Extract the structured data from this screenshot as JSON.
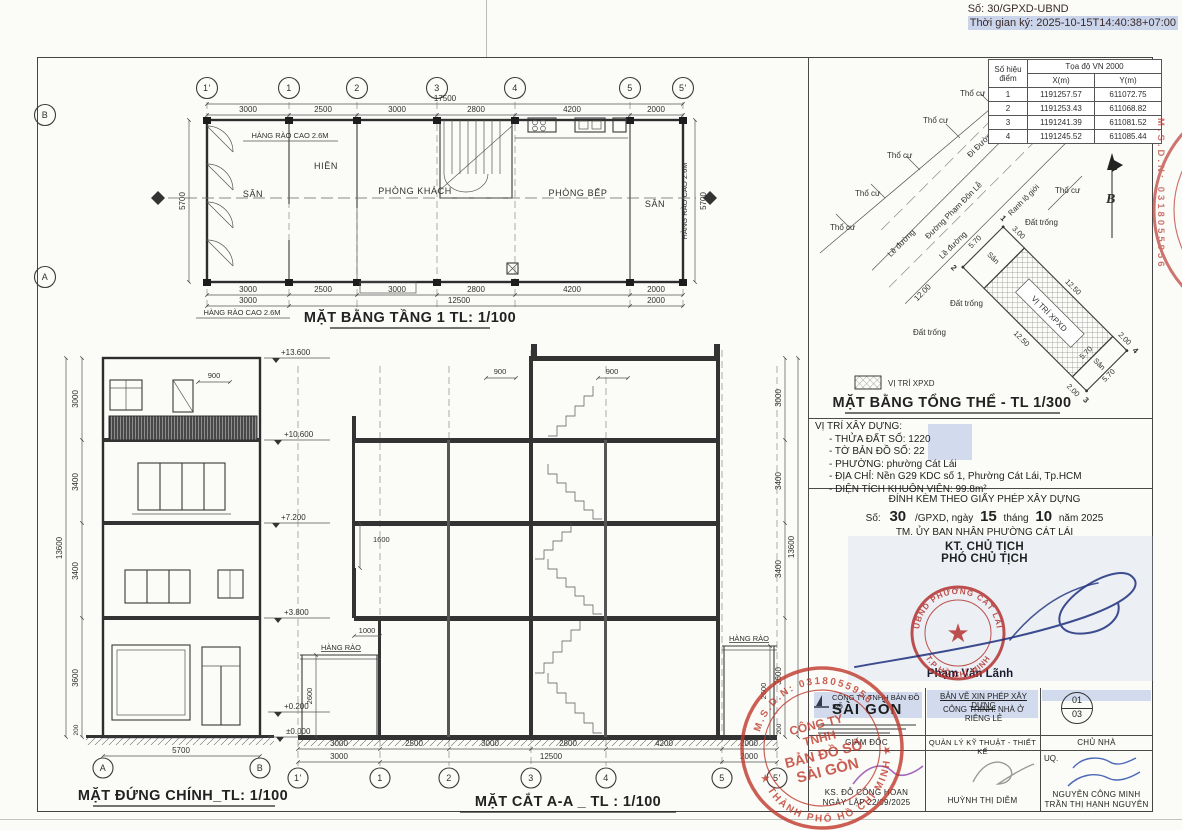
{
  "header": {
    "so": "Số: 30/GPXD-UBND",
    "time": "Thời gian ký: 2025-10-15T14:40:38+07:00"
  },
  "plan": {
    "title": "MẶT BẰNG TẦNG 1 TL: 1/100",
    "grids": [
      "1'",
      "1",
      "2",
      "3",
      "4",
      "5",
      "5'"
    ],
    "row_b": "B",
    "row_a": "A",
    "total": "17500",
    "segs": [
      "3000",
      "2500",
      "3000",
      "2800",
      "4200",
      "2000"
    ],
    "row2": [
      "3000",
      "12500",
      "2000"
    ],
    "side": "5700",
    "fence": "HÀNG RÀO CAO 2.6M",
    "rooms": [
      "SÂN",
      "HIÊN",
      "PHÒNG KHÁCH",
      "PHÒNG BẾP",
      "SÂN"
    ]
  },
  "elev": {
    "title": "MẶT ĐỨNG CHÍNH_TL: 1/100",
    "marks": [
      "+13.600",
      "+10.600",
      "+7.200",
      "+3.800",
      "+0.200",
      "±0.000"
    ],
    "vdims": [
      "3000",
      "3400",
      "3400",
      "3600",
      "200"
    ],
    "vtotal": "13600",
    "d900": "900",
    "d5700": "5700",
    "ga": "A",
    "gb": "B"
  },
  "sect": {
    "title": "MẶT CẮT A-A _ TL : 1/100",
    "grids": [
      "1'",
      "1",
      "2",
      "3",
      "4",
      "5",
      "5'"
    ],
    "segs": [
      "3000",
      "2500",
      "3000",
      "2800",
      "4200",
      "2000"
    ],
    "row2": [
      "3000",
      "12500",
      "2000"
    ],
    "vdims": [
      "3000",
      "3400",
      "3400",
      "3600",
      "200"
    ],
    "vtotal": "13600",
    "d900": "900",
    "d1600": "1600",
    "d1000": "1000",
    "d2600": "2600",
    "fence": "HÀNG RÀO"
  },
  "site": {
    "tho_cu": "Thổ cư",
    "le_duong": "Lề đường",
    "road1": "Đường Phạm Đôn Lễ",
    "road2": "Đi Đường Đàm Văn Lễ",
    "dat_trong": "Đất trống",
    "ranh": "Ranh lộ giới",
    "san": "Sân",
    "xpxd": "VỊ TRÍ XPXD",
    "north": "B",
    "d1200": "12.00",
    "d570": "5.70",
    "d1250": "12.50",
    "d300": "3.00",
    "d200": "2.00",
    "p1": "1",
    "p2": "2",
    "p3": "3",
    "p4": "4"
  },
  "coord": {
    "h_point": "Số hiệu điểm",
    "h_group": "Tọa độ VN 2000",
    "h_x": "X(m)",
    "h_y": "Y(m)",
    "rows": [
      {
        "n": "1",
        "x": "1191257.57",
        "y": "611072.75"
      },
      {
        "n": "2",
        "x": "1191253.43",
        "y": "611068.82"
      },
      {
        "n": "3",
        "x": "1191241.39",
        "y": "611081.52"
      },
      {
        "n": "4",
        "x": "1191245.52",
        "y": "611085.44"
      }
    ]
  },
  "legend": {
    "swatch": "VỊ TRÍ XPXD",
    "title": "MẶT BẰNG TỔNG THỂ - TL 1/300"
  },
  "info": {
    "heading": "VỊ TRÍ XÂY DỰNG:",
    "lines": [
      "- THỬA ĐẤT SỐ: 1220",
      "- TỜ BẢN ĐỒ SỐ: 22",
      "- PHƯỜNG: phường Cát Lái",
      "- ĐỊA CHỈ: Nền G29 KDC số 1, Phường Cát Lái, Tp.HCM",
      "- DIỆN TÍCH KHUÔN VIÊN: 99.8m²"
    ]
  },
  "permit": {
    "attach": "ĐÍNH KÈM THEO GIẤY PHÉP XÂY DỰNG",
    "so_label": "Số:",
    "so": "30",
    "mid": "/GPXD, ngày",
    "day": "15",
    "thang": "tháng",
    "month": "10",
    "nam": "năm 2025",
    "tm": "TM. ỦY BAN NHÂN PHƯỜNG CÁT LÁI",
    "kt": "KT. CHỦ TỊCH",
    "pct": "PHÓ CHỦ TỊCH",
    "signer": "Phạm Văn Lãnh",
    "stamp_top": "UBND PHƯỜNG CÁT LÁI",
    "stamp_bottom": "T.P HỒ CHÍ MINH"
  },
  "tblock": {
    "co1": "CÔNG TY TNHH BẢN ĐỒ SỐ",
    "co2": "SÀI GÒN",
    "type": "BẢN VẼ XIN PHÉP XÂY DỰNG",
    "proj": "CÔNG TRÌNH: NHÀ Ở RIÊNG LẺ",
    "pg_top": "01",
    "pg_bot": "03",
    "h1": "GIÁM ĐỐC",
    "h2": "QUẢN LÝ KỸ THUẬT - THIẾT KẾ",
    "h3": "CHỦ NHÀ",
    "eng": "KS. ĐỖ CÔNG HOAN",
    "date": "NGÀY LẬP 22/09/2025",
    "uq": "UQ.",
    "designer": "HUỲNH THỊ DIỄM",
    "owner1": "NGUYỄN CÔNG MINH",
    "owner2": "TRẦN THỊ HẠNH NGUYÊN"
  },
  "stamp_co": {
    "top": "M.S.D.N: 0318055956",
    "bottom": "★ THÀNH PHỐ HỒ CHÍ MINH ★",
    "c1": "CÔNG TY",
    "c2": "TNHH",
    "c3": "BẢN ĐỒ SỐ",
    "c4": "SÀI GÒN"
  },
  "edge_stamp": {
    "text": "M.S.D.N: 0318055956"
  },
  "colors": {
    "stamp_red": "#c0392b",
    "highlight_blue": "#ccd7ec",
    "ink_blue": "#1d2f7b"
  }
}
